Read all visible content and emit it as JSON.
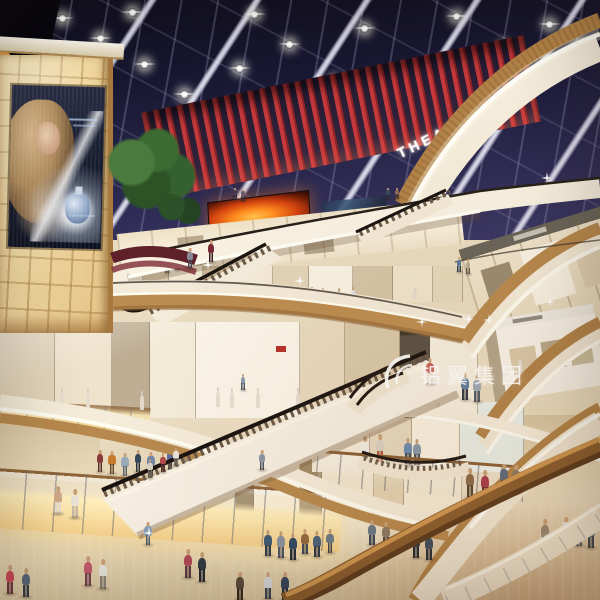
{
  "signs": {
    "theatres": "THEATRES",
    "tai_tai": "TAI TAI",
    "watermark_company": "铝翼集团"
  },
  "palette": {
    "ceiling_navy": "#1b1a36",
    "fins_red": "#c43a3c",
    "screen_fire": "#ff8d1f",
    "wood_fascia": "#b8894e",
    "cream_fascia": "#f5ecdb",
    "amber_glow": "#ffeebc",
    "wall_gold": "#f1d89f",
    "floor_beige": "#e4d4b4"
  },
  "ceiling": {
    "beams": [
      -30,
      70,
      175,
      285,
      395,
      500,
      585
    ],
    "lights": [
      [
        58,
        14
      ],
      [
        96,
        34
      ],
      [
        140,
        60
      ],
      [
        250,
        10
      ],
      [
        285,
        40
      ],
      [
        330,
        78
      ],
      [
        360,
        24
      ],
      [
        420,
        70
      ],
      [
        452,
        12
      ],
      [
        500,
        44
      ],
      [
        545,
        20
      ],
      [
        575,
        40
      ],
      [
        180,
        90
      ],
      [
        310,
        110
      ],
      [
        235,
        64
      ],
      [
        480,
        95
      ],
      [
        128,
        8
      ],
      [
        520,
        80
      ]
    ]
  },
  "sparkles": [
    [
      421,
      321
    ],
    [
      468,
      318
    ],
    [
      546,
      177
    ],
    [
      488,
      319
    ],
    [
      549,
      301
    ],
    [
      299,
      280
    ],
    [
      207,
      264
    ],
    [
      148,
      532
    ]
  ],
  "storefronts": {
    "level3": [
      [
        0,
        30,
        "#f6efdf"
      ],
      [
        30,
        26,
        "#d9c9ae"
      ],
      [
        56,
        34,
        "#efe6d0"
      ],
      [
        90,
        30,
        "#c9b696"
      ],
      [
        120,
        40,
        "#f4ead6"
      ],
      [
        160,
        36,
        "#e2d4b8"
      ],
      [
        196,
        44,
        "#f8f2e4"
      ],
      [
        240,
        40,
        "#d4c4a6"
      ],
      [
        280,
        40,
        "#efe4cc"
      ],
      [
        320,
        30,
        "#e6d8bc"
      ]
    ],
    "level2": [
      [
        0,
        55,
        "#e2d4ba"
      ],
      [
        55,
        57,
        "#efe3cc"
      ],
      [
        112,
        38,
        "#bfae94"
      ],
      [
        150,
        46,
        "#f4ecd9"
      ],
      [
        196,
        104,
        "#fbf5e8"
      ],
      [
        300,
        45,
        "#e8d9be"
      ],
      [
        345,
        55,
        "#d9c8aa"
      ],
      [
        400,
        30,
        "#5a5244"
      ],
      [
        430,
        48,
        "#f6efdf"
      ]
    ],
    "distant": [
      [
        0,
        40,
        "#f2e6cc"
      ],
      [
        40,
        18,
        "#8a7658"
      ],
      [
        58,
        46,
        "#f8eed8"
      ],
      [
        104,
        22,
        "#a08a66"
      ],
      [
        126,
        52,
        "#f4e8d0"
      ],
      [
        178,
        30,
        "#e4d2b2"
      ],
      [
        208,
        58,
        "#f6ecd6"
      ]
    ],
    "mid": [
      [
        0,
        58,
        "#f4ead6"
      ],
      [
        58,
        42,
        "#e6d8be"
      ],
      [
        100,
        48,
        "#faf2e2"
      ],
      [
        148,
        64,
        "#e9efe9"
      ]
    ]
  },
  "people": [
    [
      268,
      556,
      26,
      "#3d5a78",
      "#2c3a4c",
      0
    ],
    [
      281,
      558,
      27,
      "#8a93a2",
      "#4a5668",
      0
    ],
    [
      293,
      560,
      27,
      "#2e4a66",
      "#222e3e",
      0
    ],
    [
      305,
      554,
      25,
      "#93683f",
      "#3e4a5a",
      0
    ],
    [
      317,
      557,
      26,
      "#49637e",
      "#2e3a4a",
      0
    ],
    [
      330,
      553,
      24,
      "#6b7b8c",
      "#39434f",
      0
    ],
    [
      416,
      558,
      27,
      "#2a3444",
      "#1e2630",
      0
    ],
    [
      429,
      560,
      27,
      "#3c4c5e",
      "#262e3a",
      0
    ],
    [
      188,
      578,
      29,
      "#b0485a",
      "#5a3a42",
      0
    ],
    [
      202,
      582,
      30,
      "#2e3a46",
      "#20262e",
      0
    ],
    [
      240,
      600,
      28,
      "#5a4a3a",
      "#32291f",
      0
    ],
    [
      268,
      599,
      27,
      "#d8dae0",
      "#3a4456",
      0
    ],
    [
      285,
      600,
      28,
      "#33445a",
      "#232e3c",
      0
    ],
    [
      88,
      586,
      30,
      "#c45a6a",
      "#7a4450",
      0
    ],
    [
      103,
      589,
      30,
      "#e8e6e0",
      "#8a8478",
      0
    ],
    [
      10,
      594,
      29,
      "#cc4859",
      "#6a3540",
      0
    ],
    [
      26,
      597,
      29,
      "#57687a",
      "#333d48",
      0
    ],
    [
      148,
      545,
      23,
      "#8aa0b8",
      "#4a5a70",
      0
    ],
    [
      372,
      545,
      25,
      "#6a7888",
      "#3c4654",
      0
    ],
    [
      386,
      547,
      25,
      "#8a7a64",
      "#4a4236",
      0
    ],
    [
      545,
      549,
      30,
      "#9a8874",
      "#4a5a74",
      1
    ],
    [
      566,
      545,
      28,
      "#e8e8ea",
      "#7a8494",
      1
    ],
    [
      579,
      546,
      28,
      "#d8d4cc",
      "#5a6472",
      1
    ],
    [
      591,
      548,
      28,
      "#6a7a8c",
      "#3a4450",
      1
    ],
    [
      470,
      498,
      30,
      "#8a6a4a",
      "#52402c",
      0
    ],
    [
      485,
      500,
      30,
      "#a83a4a",
      "#6a2a34",
      0
    ],
    [
      504,
      492,
      28,
      "#5a6a7c",
      "#36414e",
      0
    ],
    [
      516,
      493,
      28,
      "#8a7a68",
      "#4c4238",
      0
    ],
    [
      100,
      472,
      22,
      "#8a3a3a",
      "#4c2a2a",
      1
    ],
    [
      112,
      474,
      23,
      "#c87a2e",
      "#5a4630",
      1
    ],
    [
      125,
      476,
      23,
      "#9aaabb",
      "#54606c",
      1
    ],
    [
      138,
      472,
      22,
      "#35465a",
      "#232e3a",
      1
    ],
    [
      151,
      475,
      23,
      "#7288a6",
      "#3e4c5e",
      1
    ],
    [
      170,
      470,
      22,
      "#5a6a9a",
      "#343e58",
      1
    ],
    [
      186,
      472,
      22,
      "#9a8a78",
      "#544a3e",
      1
    ],
    [
      58,
      514,
      28,
      "#d0a989",
      "#e6ded0",
      0
    ],
    [
      75,
      518,
      29,
      "#e9e1d5",
      "#c9b9a5",
      0
    ],
    [
      262,
      470,
      20,
      "#8a96a8",
      "#4a525e",
      0
    ],
    [
      150,
      478,
      19,
      "#d8d0c6",
      "#6a625a",
      0
    ],
    [
      163,
      472,
      19,
      "#b04a4c",
      "#5c2c2e",
      0
    ],
    [
      176,
      466,
      18,
      "#e8e4da",
      "#7a746a",
      0
    ],
    [
      430,
      384,
      26,
      "#c4564a",
      "#e8e0d4",
      0
    ],
    [
      258,
      306,
      16,
      "#7a8a9c",
      "#44505c",
      1
    ],
    [
      270,
      307,
      16,
      "#b8743e",
      "#5c3a22",
      1
    ],
    [
      300,
      305,
      18,
      "#f0ede6",
      "#8a867c",
      1
    ],
    [
      312,
      304,
      17,
      "#8aacc8",
      "#4c6278",
      1
    ],
    [
      323,
      306,
      18,
      "#cc8a46",
      "#63432a",
      1
    ],
    [
      339,
      305,
      17,
      "#7a99ac",
      "#42565e",
      1
    ],
    [
      353,
      304,
      17,
      "#e0e2e8",
      "#787e8a",
      1
    ],
    [
      177,
      270,
      14,
      "#aa7766",
      "#5c4038",
      1
    ],
    [
      167,
      273,
      15,
      "#99aabb",
      "#505c68",
      1
    ],
    [
      388,
      200,
      12,
      "#38485c",
      "#242e3a",
      0
    ],
    [
      397,
      199,
      11,
      "#8a6a56",
      "#4a392e",
      0
    ],
    [
      235,
      200,
      12,
      "#4a3a50",
      "#2e2436",
      0
    ],
    [
      243,
      201,
      12,
      "#6a5a6a",
      "#3a3040",
      0
    ],
    [
      465,
      400,
      27,
      "#56789c",
      "#303a46",
      0
    ],
    [
      477,
      402,
      27,
      "#9aa8b6",
      "#525c66",
      0
    ],
    [
      459,
      272,
      15,
      "#5a7a9c",
      "#303f52",
      0
    ],
    [
      468,
      274,
      15,
      "#b8a890",
      "#5f5648",
      0
    ],
    [
      243,
      390,
      16,
      "#8a9aac",
      "#4e5a66",
      0
    ],
    [
      190,
      268,
      20,
      "#8a8a96",
      "#4a4a56",
      0
    ],
    [
      211,
      262,
      22,
      "#7a2a34",
      "#3a1a20",
      0
    ],
    [
      365,
      466,
      30,
      "#f0ede8",
      "#8a7a5a",
      1
    ],
    [
      380,
      464,
      30,
      "#d8d0c0",
      "#b05a3a",
      1
    ],
    [
      408,
      464,
      26,
      "#6a8ab0",
      "#3c4a5c",
      1
    ],
    [
      417,
      465,
      26,
      "#8898a8",
      "#4a5462",
      1
    ]
  ],
  "mannequins": [
    [
      62,
      408,
      20
    ],
    [
      88,
      409,
      20
    ],
    [
      142,
      410,
      19
    ],
    [
      218,
      407,
      20
    ],
    [
      232,
      408,
      20
    ],
    [
      258,
      408,
      20
    ],
    [
      298,
      407,
      19
    ],
    [
      332,
      408,
      19
    ],
    [
      362,
      407,
      19
    ],
    [
      438,
      408,
      18
    ],
    [
      520,
      372,
      15
    ],
    [
      536,
      373,
      15
    ],
    [
      552,
      371,
      15
    ],
    [
      200,
      296,
      12
    ],
    [
      225,
      297,
      12
    ],
    [
      415,
      300,
      12
    ],
    [
      340,
      438,
      16
    ],
    [
      352,
      437,
      16
    ]
  ]
}
